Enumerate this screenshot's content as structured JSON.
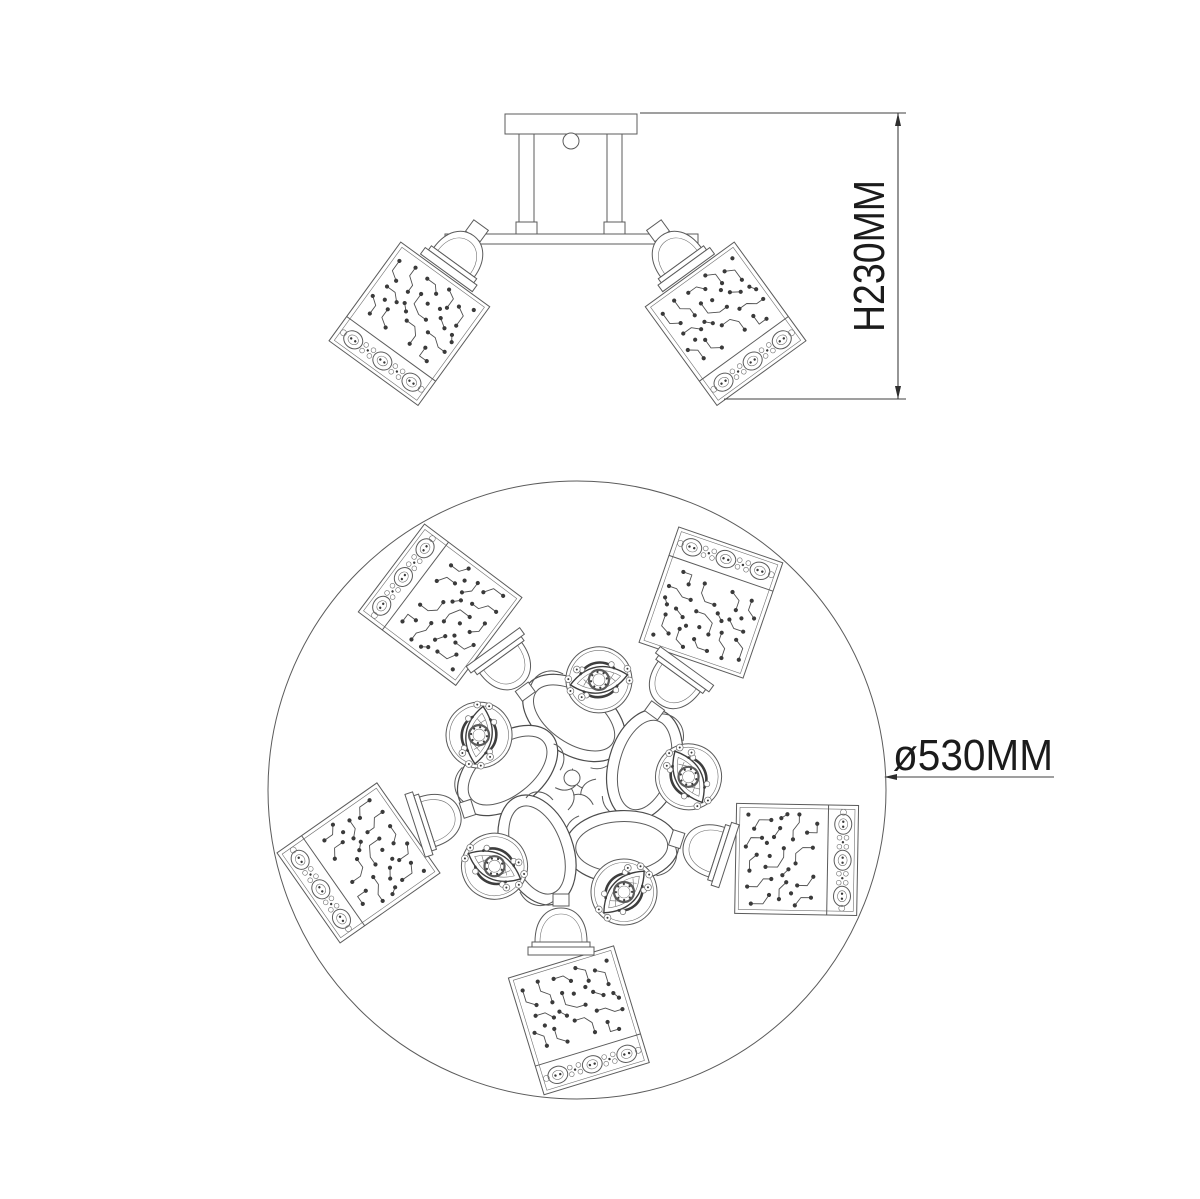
{
  "dimensions": {
    "height_label": "H230MM",
    "diameter_label": "ø530MM"
  },
  "plan_view": {
    "shade_count": 5,
    "medallion_count": 5,
    "diameter_label": "ø530MM"
  },
  "side_view": {
    "shade_count": 2,
    "height_label": "H230MM"
  },
  "colors": {
    "background": "#ffffff",
    "line": "#555555",
    "text": "#1b1b1b"
  }
}
